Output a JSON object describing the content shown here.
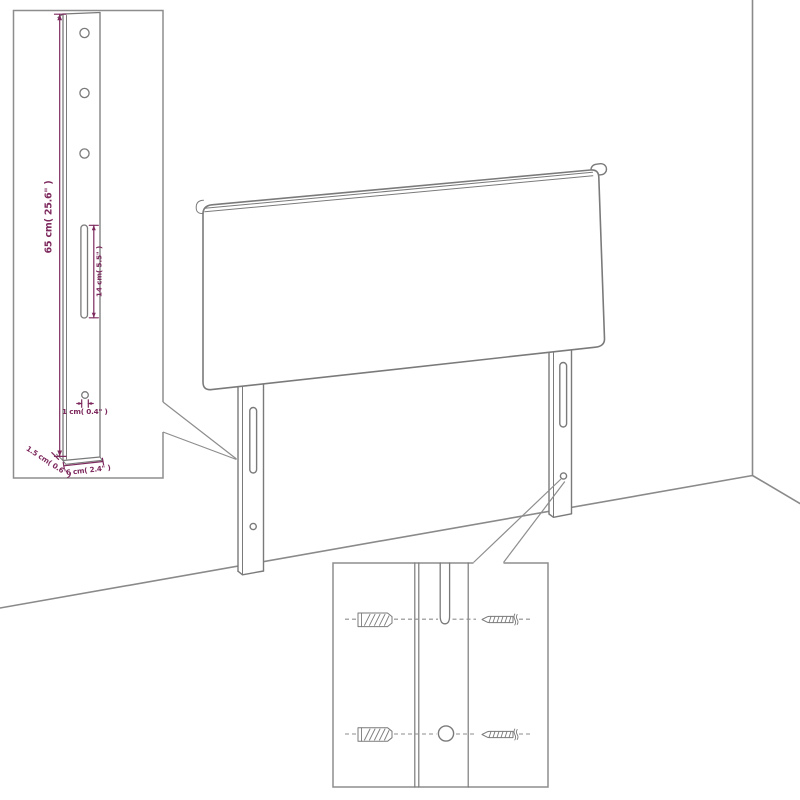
{
  "figure": {
    "title": "Headboard wall-mounting assembly diagram",
    "background": "#ffffff"
  },
  "colors": {
    "outline_gray": "#7a7a7a",
    "wall_gray": "#8a8a8a",
    "callout_box_gray": "#8d8d8d",
    "dimension_purple": "#7d295d"
  },
  "leg_detail": {
    "height_label": "65 cm( 25.6\" )",
    "slot_label": "14 cm( 5.5\" )",
    "hole_label": "1 cm( 0.4\" )",
    "depth_label": "1.5 cm( 0.6\" )",
    "width_label": "6 cm( 2.4\" )",
    "hole_count": 3
  },
  "mount_detail": {
    "icons": {
      "wall_plug": "wall-plug-icon",
      "screw": "screw-icon"
    },
    "rows": 2
  }
}
